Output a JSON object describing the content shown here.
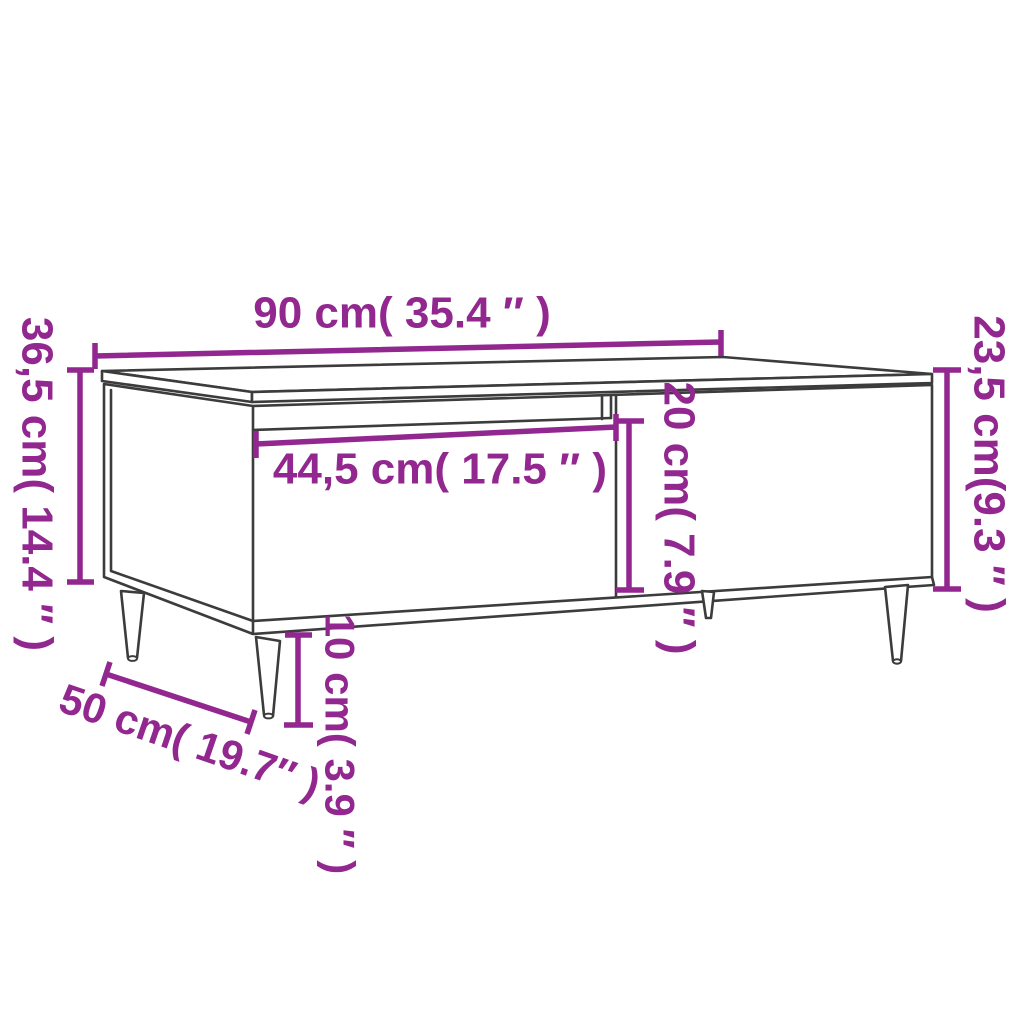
{
  "diagram": {
    "title": "Coffee table dimension diagram",
    "colors": {
      "dimension_accent": "#92278F",
      "outline": "#3C3C3C",
      "background": "#FFFFFF"
    },
    "labels": {
      "width": "90 cm( 35.4 ″ )",
      "height_total": "36,5 cm( 14.4 ″ )",
      "height_body": "23,5 cm(9.3 ″ )",
      "drawer_width": "44,5 cm( 17.5 ″ )",
      "inner_height": "20 cm( 7.9 ″ )",
      "depth": "50 cm( 19.7″ )",
      "leg_height": "10 cm( 3.9 ″ )"
    }
  }
}
